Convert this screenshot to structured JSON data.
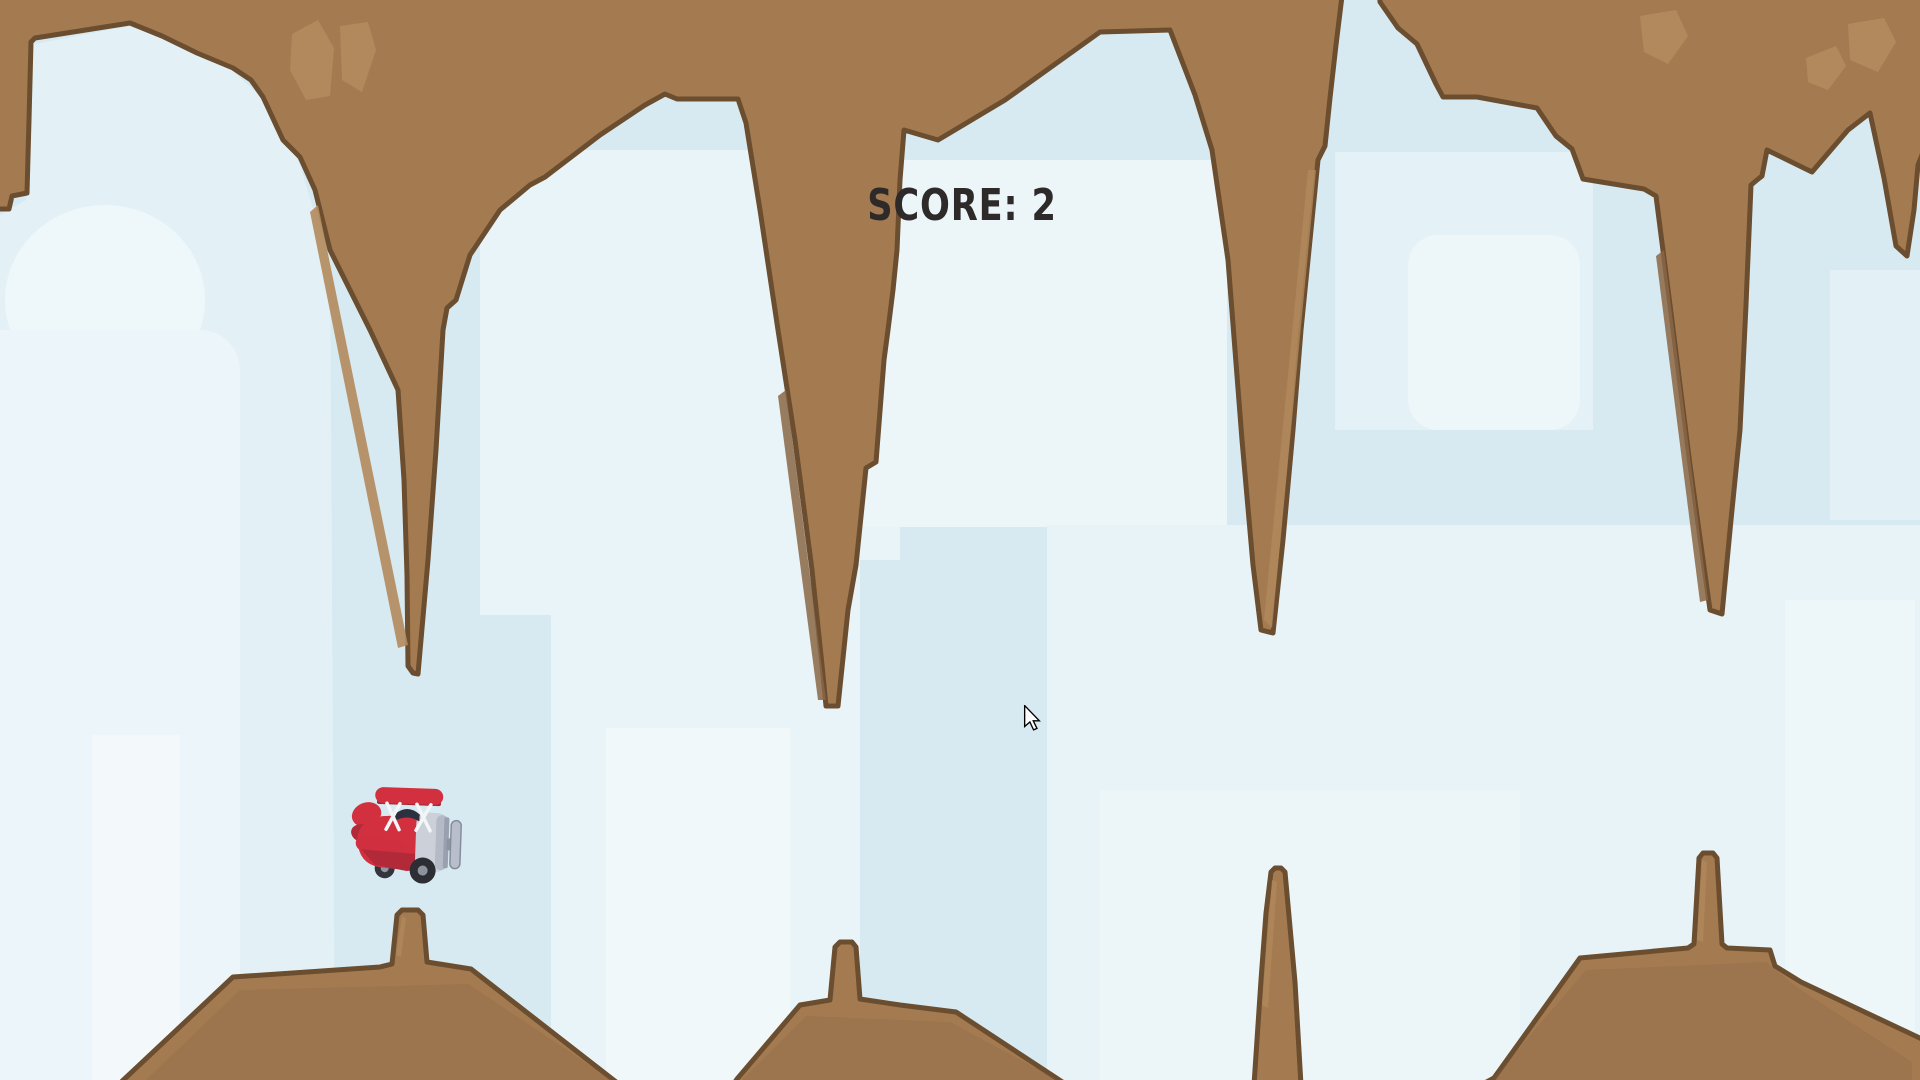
{
  "hud": {
    "score": "SCORE: 2"
  },
  "game": {
    "title": "flappy-plane-cave-game",
    "player_sprite": "red-biplane-icon",
    "obstacles": {
      "ceiling_stalactites": 5,
      "ground_stalagmites": 4
    },
    "cursor": "arrow-cursor-icon"
  },
  "colors": {
    "sky_base": "#d7eaf1",
    "cloud_light": "#e9f4f8",
    "cloud_bright": "#eef7fa",
    "terrain_fill": "#a47b51",
    "terrain_outline": "#6b4d2f",
    "terrain_patch": "#b2895c",
    "terrain_shadow": "#8a6644",
    "plane_red": "#d2303e",
    "plane_red_dark": "#b22a39",
    "plane_gray": "#ccd1d9",
    "score_text": "#2e2a2a"
  }
}
